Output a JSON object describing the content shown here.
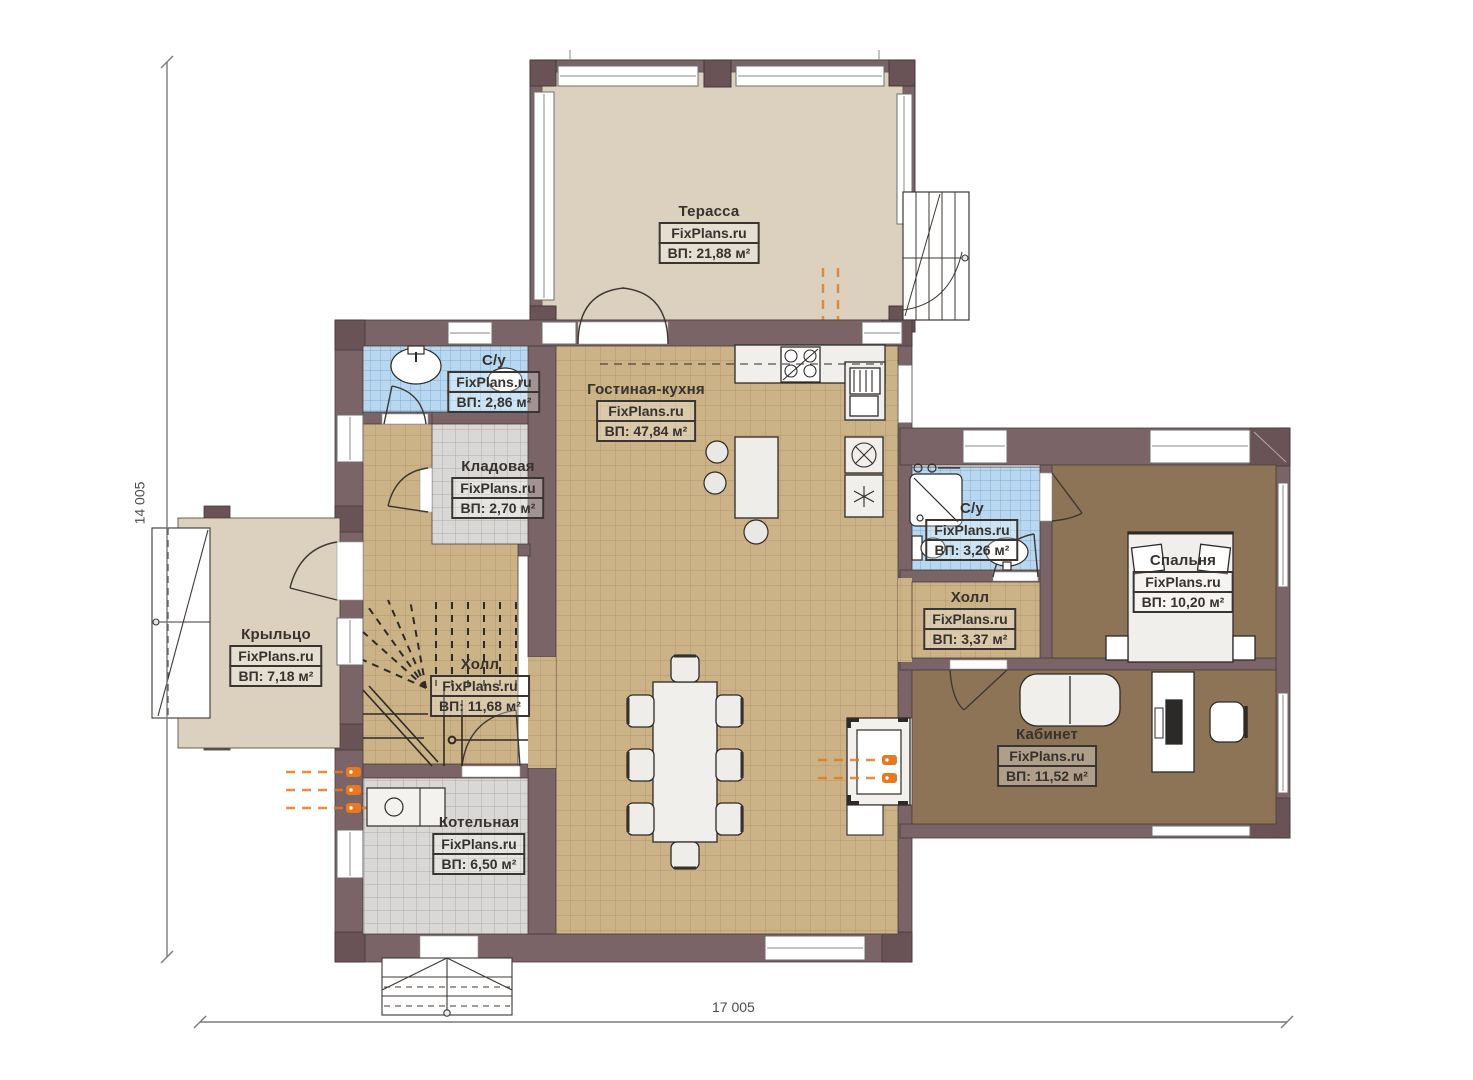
{
  "plan": {
    "watermark": "FixPlans.ru",
    "dimensions": {
      "height_mm": "14 005",
      "width_mm": "17 005"
    }
  },
  "rooms": [
    {
      "id": "terrace",
      "name": "Терасса",
      "watermark": "FixPlans.ru",
      "area": "ВП: 21,88 м²"
    },
    {
      "id": "su-1",
      "name": "С/у",
      "watermark": "FixPlans.ru",
      "area": "ВП: 2,86 м²"
    },
    {
      "id": "living-kitchen",
      "name": "Гостиная-кухня",
      "watermark": "FixPlans.ru",
      "area": "ВП: 47,84 м²"
    },
    {
      "id": "storage",
      "name": "Кладовая",
      "watermark": "FixPlans.ru",
      "area": "ВП: 2,70 м²"
    },
    {
      "id": "porch",
      "name": "Крыльцо",
      "watermark": "FixPlans.ru",
      "area": "ВП: 7,18 м²"
    },
    {
      "id": "hall-1",
      "name": "Холл",
      "watermark": "FixPlans.ru",
      "area": "ВП: 11,68 м²"
    },
    {
      "id": "boiler",
      "name": "Котельная",
      "watermark": "FixPlans.ru",
      "area": "ВП: 6,50 м²"
    },
    {
      "id": "su-2",
      "name": "С/у",
      "watermark": "FixPlans.ru",
      "area": "ВП: 3,26 м²"
    },
    {
      "id": "hall-2",
      "name": "Холл",
      "watermark": "FixPlans.ru",
      "area": "ВП: 3,37 м²"
    },
    {
      "id": "bedroom",
      "name": "Спальня",
      "watermark": "FixPlans.ru",
      "area": "ВП: 10,20 м²"
    },
    {
      "id": "office",
      "name": "Кабинет",
      "watermark": "FixPlans.ru",
      "area": "ВП: 11,52 м²"
    }
  ],
  "colors": {
    "wall": "#7a6467",
    "wall_column": "#6a5356",
    "floor_terrace": "#dcd1be",
    "floor_tan": "#cbb287",
    "floor_blue": "#b7d8f0",
    "floor_gray": "#d9d8d6",
    "floor_brown": "#8d7457",
    "pipes_orange": "#e8791f"
  }
}
